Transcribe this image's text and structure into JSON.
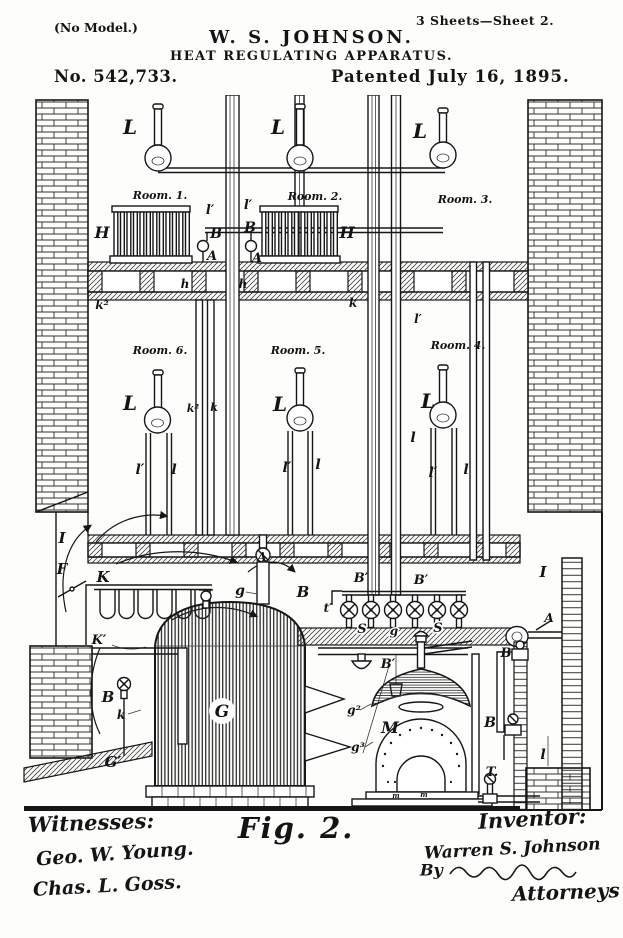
{
  "page": {
    "model_note": "(No Model.)",
    "sheet_note": "3 Sheets—Sheet 2.",
    "author": "W. S. JOHNSON.",
    "title": "HEAT REGULATING APPARATUS.",
    "patent_number": "No. 542,733.",
    "patent_date": "Patented July 16, 1895."
  },
  "figure": {
    "caption": "Fig. 2.",
    "ink_color": "#161616",
    "paper_color": "#fdfdfb",
    "labels": [
      {
        "t": "L",
        "x": 130,
        "y": 134,
        "fs": 20
      },
      {
        "t": "L",
        "x": 278,
        "y": 134,
        "fs": 20
      },
      {
        "t": "L",
        "x": 420,
        "y": 138,
        "fs": 20
      },
      {
        "t": "Room. 1.",
        "x": 160,
        "y": 199,
        "fs": 11
      },
      {
        "t": "Room. 2.",
        "x": 315,
        "y": 200,
        "fs": 11
      },
      {
        "t": "Room. 3.",
        "x": 465,
        "y": 203,
        "fs": 11
      },
      {
        "t": "H",
        "x": 102,
        "y": 238,
        "fs": 16
      },
      {
        "t": "H",
        "x": 347,
        "y": 238,
        "fs": 16
      },
      {
        "t": "l′",
        "x": 210,
        "y": 214,
        "fs": 13
      },
      {
        "t": "l′",
        "x": 248,
        "y": 209,
        "fs": 13
      },
      {
        "t": "B",
        "x": 216,
        "y": 238,
        "fs": 14
      },
      {
        "t": "B",
        "x": 250,
        "y": 232,
        "fs": 14
      },
      {
        "t": "A",
        "x": 212,
        "y": 260,
        "fs": 13
      },
      {
        "t": "A",
        "x": 257,
        "y": 262,
        "fs": 13
      },
      {
        "t": "h",
        "x": 185,
        "y": 288,
        "fs": 12
      },
      {
        "t": "h",
        "x": 243,
        "y": 288,
        "fs": 12
      },
      {
        "t": "k²",
        "x": 102,
        "y": 309,
        "fs": 12
      },
      {
        "t": "k",
        "x": 353,
        "y": 307,
        "fs": 12
      },
      {
        "t": "Room. 6.",
        "x": 160,
        "y": 354,
        "fs": 11
      },
      {
        "t": "Room. 5.",
        "x": 298,
        "y": 354,
        "fs": 11
      },
      {
        "t": "Room. 4.",
        "x": 458,
        "y": 349,
        "fs": 11
      },
      {
        "t": "l′",
        "x": 418,
        "y": 323,
        "fs": 12
      },
      {
        "t": "L",
        "x": 130,
        "y": 410,
        "fs": 20
      },
      {
        "t": "L",
        "x": 280,
        "y": 411,
        "fs": 20
      },
      {
        "t": "L",
        "x": 428,
        "y": 408,
        "fs": 20
      },
      {
        "t": "k²",
        "x": 193,
        "y": 412,
        "fs": 11
      },
      {
        "t": "k",
        "x": 214,
        "y": 411,
        "fs": 11
      },
      {
        "t": "l",
        "x": 413,
        "y": 442,
        "fs": 14
      },
      {
        "t": "l′",
        "x": 140,
        "y": 474,
        "fs": 14
      },
      {
        "t": "l",
        "x": 174,
        "y": 474,
        "fs": 14
      },
      {
        "t": "l′",
        "x": 287,
        "y": 472,
        "fs": 14
      },
      {
        "t": "l",
        "x": 318,
        "y": 469,
        "fs": 14
      },
      {
        "t": "l′",
        "x": 433,
        "y": 477,
        "fs": 14
      },
      {
        "t": "l",
        "x": 466,
        "y": 474,
        "fs": 14
      },
      {
        "t": "I",
        "x": 62,
        "y": 543,
        "fs": 15
      },
      {
        "t": "F",
        "x": 62,
        "y": 574,
        "fs": 15
      },
      {
        "t": "K",
        "x": 103,
        "y": 582,
        "fs": 15
      },
      {
        "t": "K′",
        "x": 99,
        "y": 644,
        "fs": 13
      },
      {
        "t": "A",
        "x": 262,
        "y": 561,
        "fs": 12
      },
      {
        "t": "g",
        "x": 240,
        "y": 595,
        "fs": 14
      },
      {
        "t": "B",
        "x": 303,
        "y": 597,
        "fs": 15
      },
      {
        "t": "B′",
        "x": 361,
        "y": 582,
        "fs": 13
      },
      {
        "t": "B′",
        "x": 421,
        "y": 584,
        "fs": 13
      },
      {
        "t": "t′",
        "x": 328,
        "y": 612,
        "fs": 12
      },
      {
        "t": "S",
        "x": 362,
        "y": 633,
        "fs": 13,
        "halo": 1
      },
      {
        "t": "g",
        "x": 394,
        "y": 635,
        "fs": 12,
        "halo": 1
      },
      {
        "t": "S",
        "x": 438,
        "y": 632,
        "fs": 13,
        "halo": 1
      },
      {
        "t": "I",
        "x": 543,
        "y": 577,
        "fs": 15
      },
      {
        "t": "A",
        "x": 549,
        "y": 622,
        "fs": 12
      },
      {
        "t": "B",
        "x": 506,
        "y": 657,
        "fs": 13
      },
      {
        "t": "B′",
        "x": 388,
        "y": 668,
        "fs": 13
      },
      {
        "t": "G",
        "x": 222,
        "y": 717,
        "fs": 17
      },
      {
        "t": "g²",
        "x": 354,
        "y": 714,
        "fs": 12
      },
      {
        "t": "g³",
        "x": 358,
        "y": 751,
        "fs": 12
      },
      {
        "t": "M",
        "x": 390,
        "y": 733,
        "fs": 16
      },
      {
        "t": "B",
        "x": 490,
        "y": 727,
        "fs": 14
      },
      {
        "t": "T.",
        "x": 492,
        "y": 776,
        "fs": 13
      },
      {
        "t": "l",
        "x": 543,
        "y": 759,
        "fs": 14
      },
      {
        "t": "B",
        "x": 108,
        "y": 702,
        "fs": 15
      },
      {
        "t": "k",
        "x": 121,
        "y": 719,
        "fs": 12
      },
      {
        "t": "G′",
        "x": 113,
        "y": 767,
        "fs": 15
      },
      {
        "t": "m",
        "x": 396,
        "y": 798,
        "fs": 7
      },
      {
        "t": "m",
        "x": 424,
        "y": 797,
        "fs": 7
      }
    ]
  },
  "signatures": {
    "witnesses_heading": "Witnesses:",
    "witness1": "Geo. W. Young.",
    "witness2": "Chas. L. Goss.",
    "inventor_heading": "Inventor:",
    "inventor_name": "Warren S. Johnson",
    "by_label": "By",
    "attorneys_label": "Attorneys"
  }
}
